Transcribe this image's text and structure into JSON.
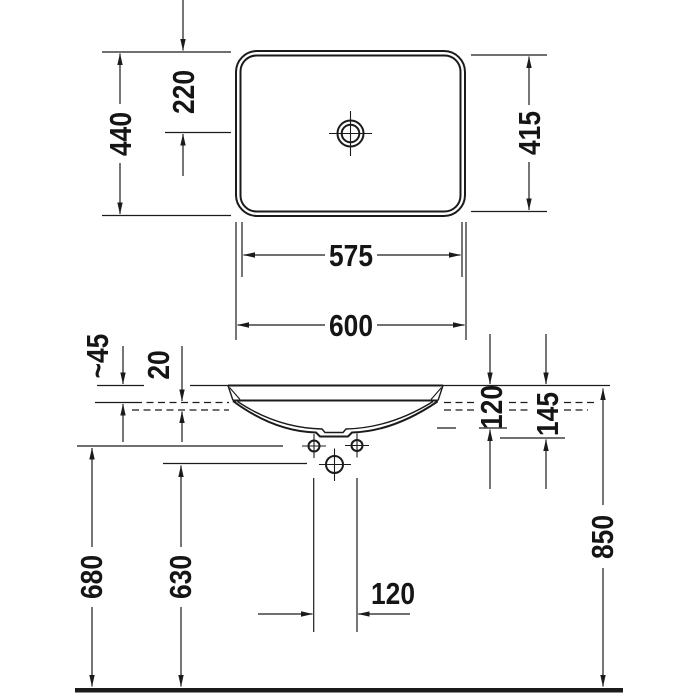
{
  "drawing": {
    "type": "washbasin technical dimension drawing",
    "colors": {
      "background": "#ffffff",
      "line": "#1b1b1b",
      "text": "#151515"
    },
    "top_view": {
      "overall_depth": "440",
      "edge_to_drain": "220",
      "inner_depth": "415",
      "inner_width": "575",
      "overall_width": "600"
    },
    "front_view": {
      "rim_above_counter": "~45",
      "counter_recess": "20",
      "depth_to_bowl_bottom": "120",
      "depth_to_drain_flange": "145",
      "fixing_holes_height": "680",
      "drain_height": "630",
      "fixing_holes_spacing": "120",
      "rim_height_above_floor": "850"
    }
  }
}
